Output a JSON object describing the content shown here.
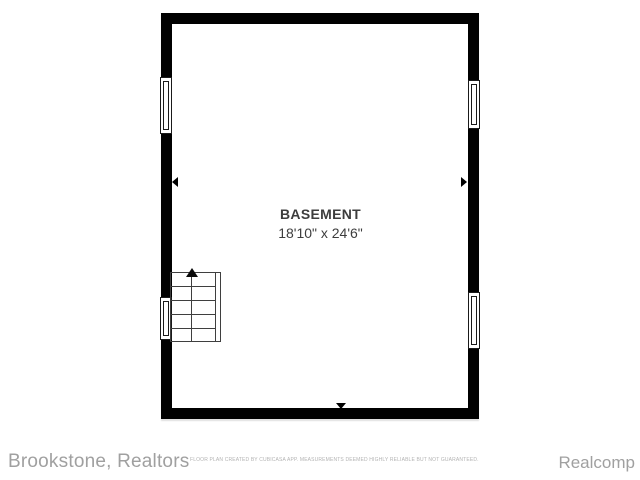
{
  "floor_plan": {
    "room": {
      "label": "BASEMENT",
      "dimensions": "18'10\" x 24'6\""
    },
    "features": {
      "windows": [
        "left-wall-upper",
        "left-wall-lower",
        "right-wall-upper",
        "right-wall-lower"
      ],
      "stairs": "staircase-bottom-left-with-up-arrow",
      "wall_markers": [
        "top-outward-arrow",
        "bottom-outward-arrow",
        "left-outward-arrow",
        "right-outward-arrow"
      ]
    },
    "colors": {
      "wall": "#000000",
      "label_text": "#3d3d3d",
      "background": "#ffffff",
      "footer_text": "#a0a0a0",
      "disclaimer_text": "#b3b3b3"
    }
  },
  "footer": {
    "brand": "Brookstone, Realtors",
    "disclaimer": "FLOOR PLAN CREATED BY CUBICASA APP. MEASUREMENTS DEEMED HIGHLY RELIABLE BUT NOT GUARANTEED.",
    "attribution": "Realcomp"
  }
}
